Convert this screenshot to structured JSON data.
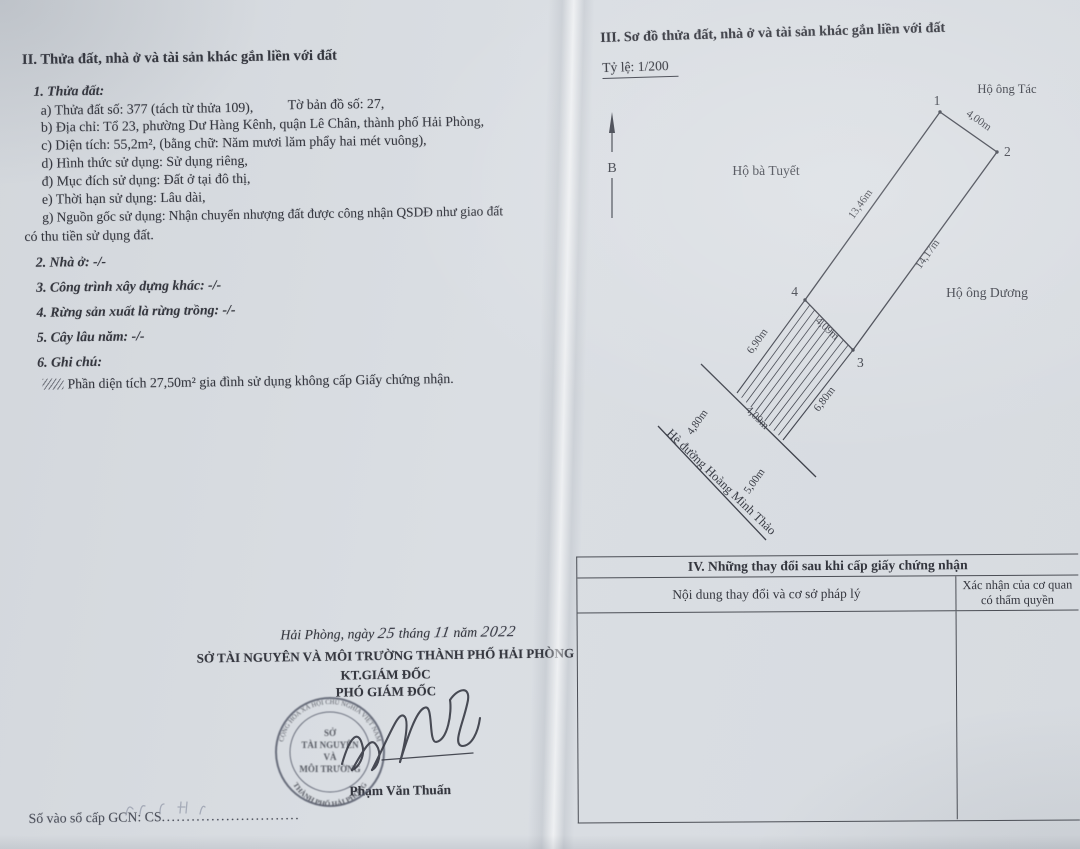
{
  "doc": {
    "heading": "II. Thửa đất, nhà ở và tài sản khác gắn liền với đất",
    "sub1": "1. Thửa đất:",
    "a1": "a) Thửa đất số: 377 (tách từ thửa 109),",
    "a2": "Tờ bản đồ số: 27,",
    "b": "b) Địa chỉ: Tổ 23, phường Dư Hàng Kênh, quận Lê Chân, thành phố Hải Phòng,",
    "c": "c) Diện tích: 55,2m², (bằng chữ: Năm mươi lăm phẩy hai mét vuông),",
    "d": "d) Hình thức sử dụng: Sử dụng riêng,",
    "dd": "đ) Mục đích sử dụng: Đất ở tại đô thị,",
    "e": "e) Thời hạn sử dụng: Lâu dài,",
    "g1": "g) Nguồn gốc sử dụng: Nhận chuyển nhượng đất được công nhận QSDĐ như giao đất",
    "g2": "có thu tiền sử dụng đất.",
    "sub2": "2. Nhà ở: -/-",
    "sub3": "3. Công trình xây dựng khác: -/-",
    "sub4": "4. Rừng sản xuất là rừng trồng: -/-",
    "sub5": "5. Cây lâu năm: -/-",
    "sub6": "6. Ghi chú:",
    "note": "Phần diện tích 27,50m² gia đình sử dụng không cấp Giấy chứng nhận."
  },
  "sig": {
    "place": "Hải Phòng, ngày",
    "day": "25",
    "thang": "tháng",
    "month": "11",
    "nam": "năm",
    "year": "2022",
    "agency": "SỞ TÀI NGUYÊN VÀ MÔI TRƯỜNG THÀNH PHỐ HẢI PHÒNG",
    "title1": "KT.GIÁM ĐỐC",
    "title2": "PHÓ GIÁM ĐỐC",
    "signer": "Phạm Văn Thuấn",
    "seal_top": "CỘNG HÒA XÃ HỘI CHỦ NGHĨA VIỆT NAM",
    "seal_c1": "SỞ",
    "seal_c2": "TÀI NGUYÊN",
    "seal_c3": "VÀ",
    "seal_c4": "MÔI TRƯỜNG",
    "seal_bottom": "THÀNH PHỐ HẢI PHÒNG"
  },
  "footer": {
    "gcn_label": "Số vào sổ cấp GCN: CS",
    "gcn_dots": "............................"
  },
  "plan": {
    "heading": "III. Sơ đồ thửa đất, nhà ở và tài sản khác gắn liền với đất",
    "scale": "Tỷ lệ: 1/200",
    "north": "B",
    "neighbor_top": "Hộ ông Tác",
    "neighbor_left": "Hộ bà Tuyết",
    "neighbor_right": "Hộ ông Dương",
    "street": "Hè đường Hoàng Minh Thảo",
    "p1": "1",
    "p2": "2",
    "p3": "3",
    "p4": "4",
    "m_12": "4,00m",
    "m_14": "13,46m",
    "m_23": "14,17m",
    "m_43": "4,09m",
    "m_hatch_left": "6,90m",
    "m_hatch_right": "6,80m",
    "m_hatch_bottom": "4,09m",
    "m_side_left": "4,80m",
    "m_side_right": "5,00m"
  },
  "table4": {
    "title": "IV. Những thay đổi sau khi cấp giấy chứng nhận",
    "col1": "Nội dung thay đổi và cơ sở pháp lý",
    "col2": "Xác nhận của cơ quan có thẩm quyền"
  }
}
